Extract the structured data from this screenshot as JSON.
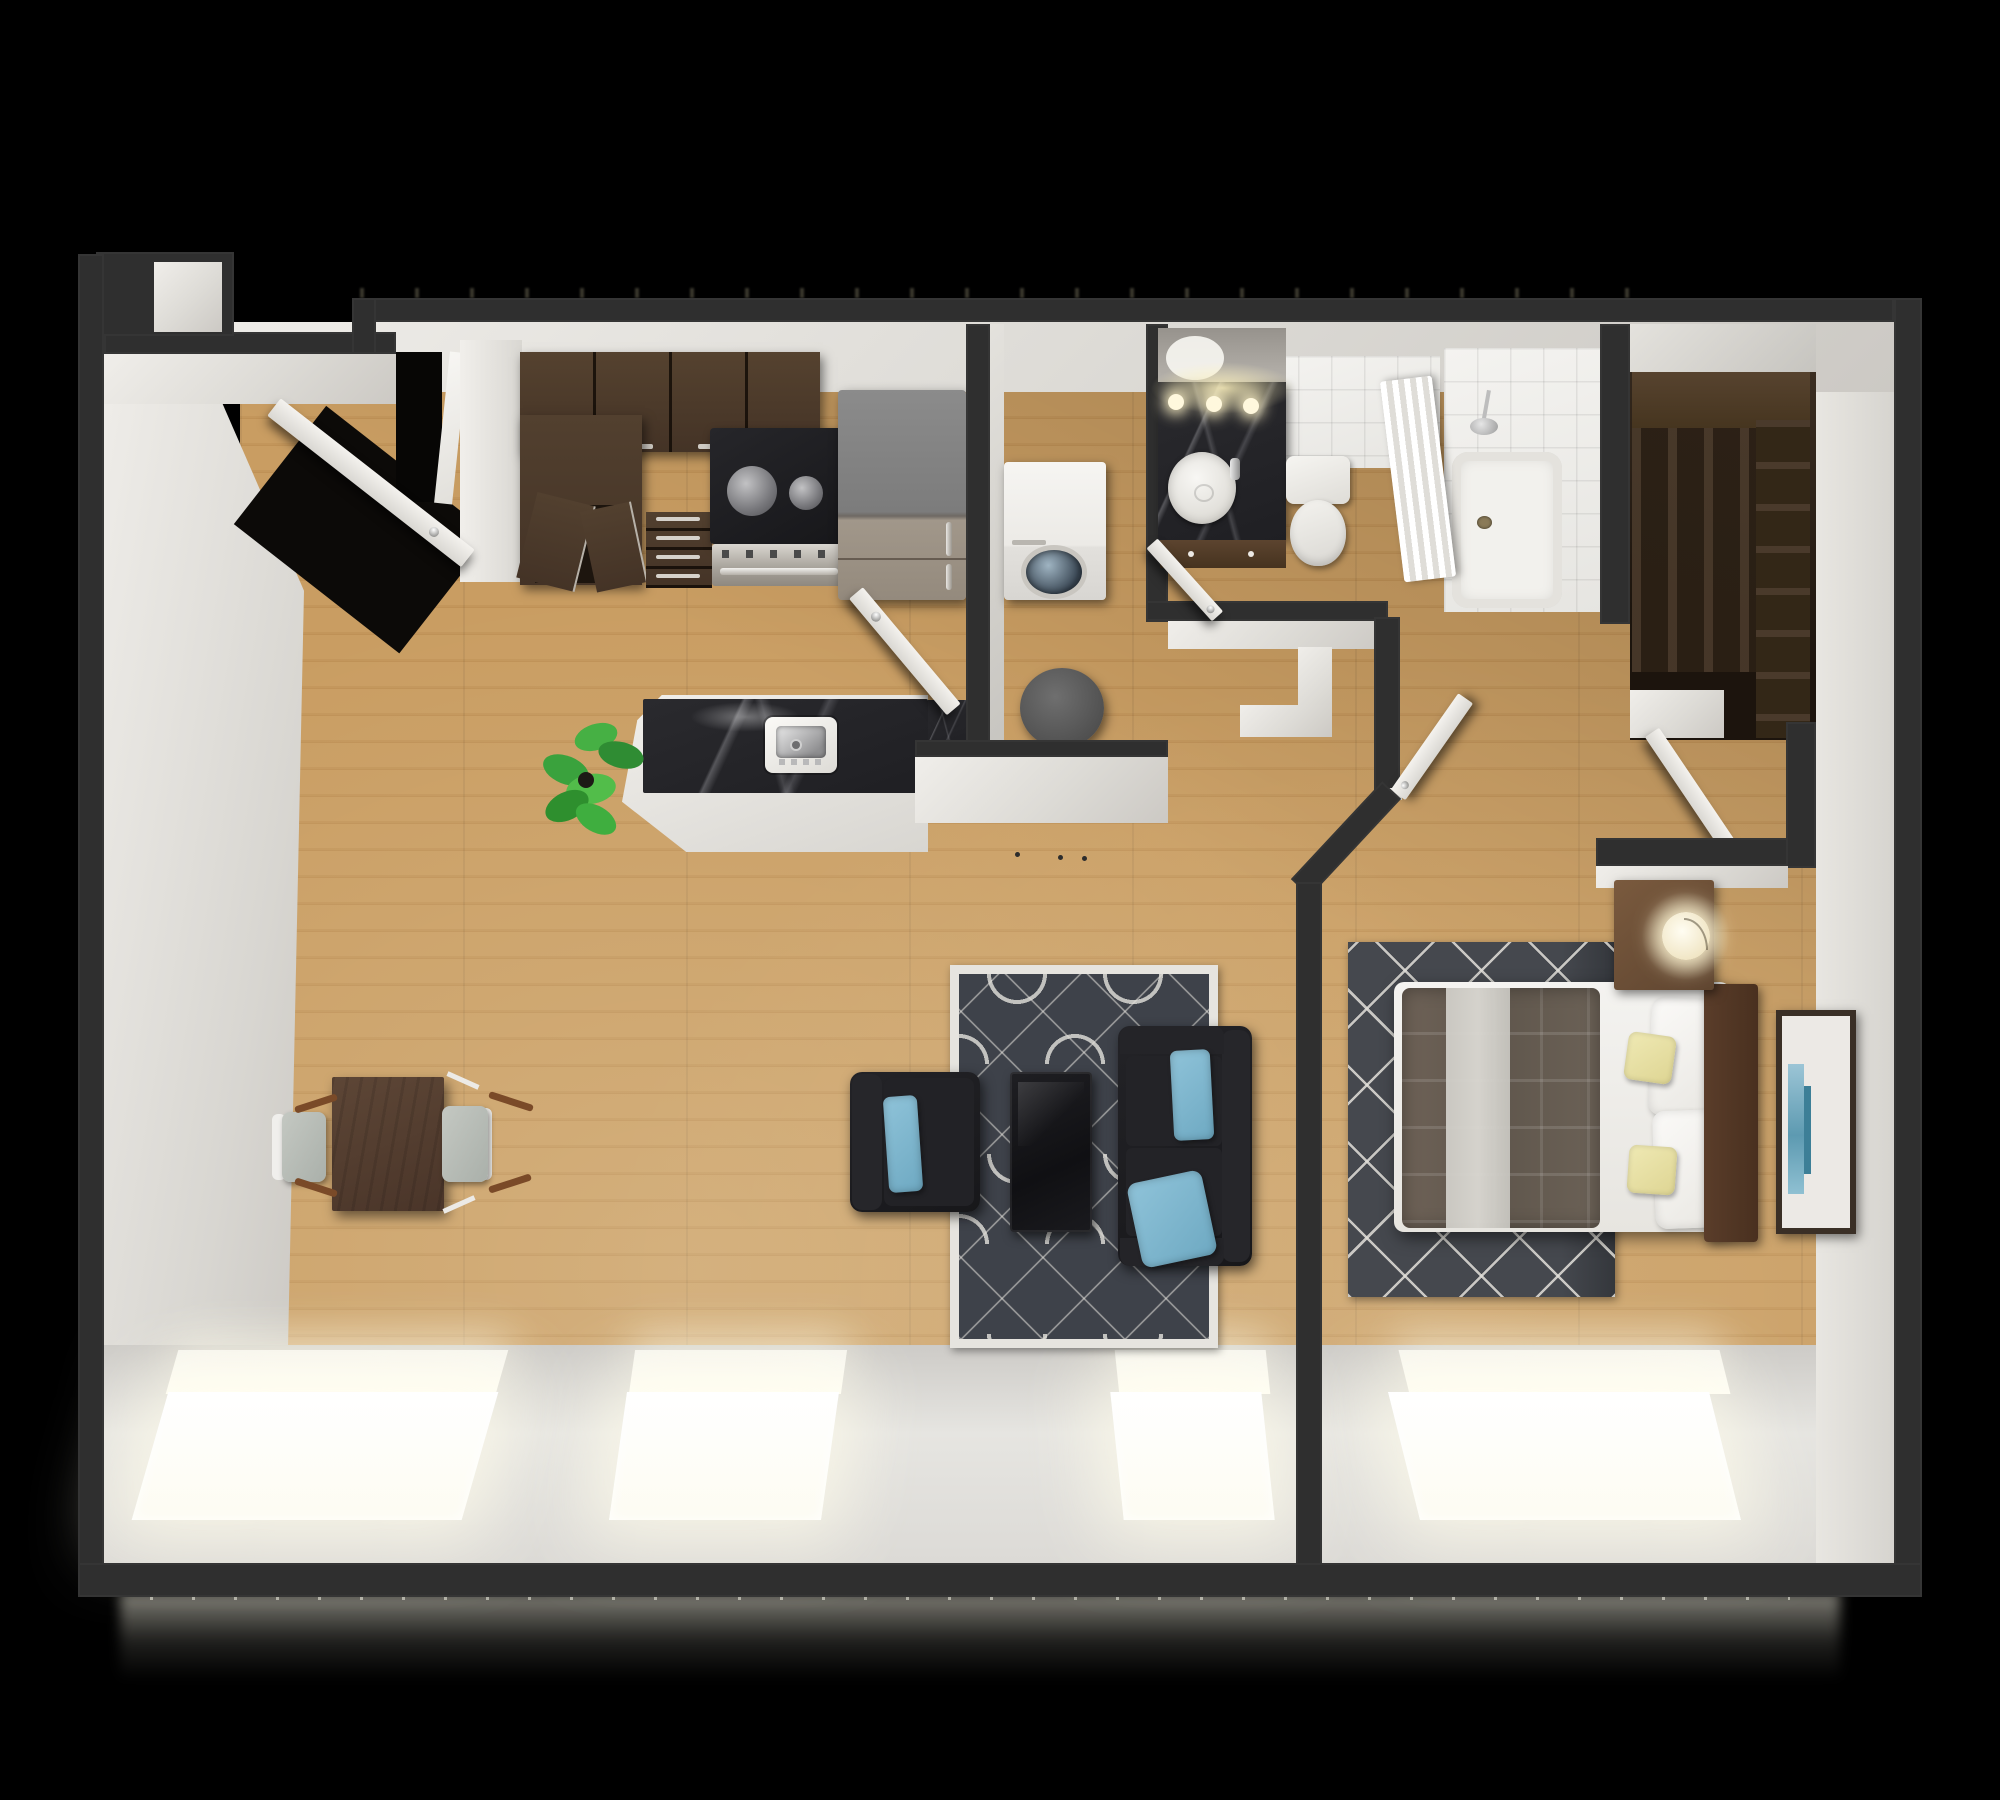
{
  "scene": {
    "kind": "3d-rendered-floor-plan",
    "view": "top-down dollhouse",
    "background": "#000000",
    "apartment_type": "one-bedroom apartment"
  },
  "palette": {
    "wall": "#2f2f2f",
    "wallLight": "#3f3f3f",
    "wallFace": "#e9e7e2",
    "wood": "#c59a5f",
    "marble": "#232327",
    "espresso": "#443326",
    "espressoTop": "#52402f",
    "espressoDeep": "#241a11",
    "fridgeGray": "#828282",
    "steel": "#b9b4ac",
    "furnitureWhite": "#f1f0ed",
    "accentBlue": "#7db6ce",
    "accentYellow": "#e9e2a5",
    "quilt": "#6b655a",
    "rugLiving": "#3e424a",
    "rugBedroom": "#45484e",
    "rugLine": "#e1dfd9",
    "headboard": "#4e3424",
    "nightstand": "#6f5138",
    "plantGreen": "#3fae3f",
    "windowGlow": "#fffce8"
  },
  "rooms": [
    {
      "name": "living-dining-room",
      "floor": "hardwood",
      "furniture": [
        "dining table",
        "2 dining chairs",
        "potted plant",
        "armchair with blue pillow",
        "loveseat sofa with 2 blue pillows",
        "dark coffee table",
        "patterned area rug"
      ]
    },
    {
      "name": "kitchen",
      "floor": "hardwood",
      "furniture": [
        "upper cabinets (4 doors)",
        "tall pantry cabinet with open doors",
        "drawer stack (4 drawers)",
        "range with 2 burners",
        "refrigerator",
        "island with black marble top and sink"
      ]
    },
    {
      "name": "laundry-nook",
      "floor": "hardwood",
      "furniture": [
        "front-load washer",
        "round gray side table"
      ]
    },
    {
      "name": "hallway",
      "floor": "hardwood",
      "furniture": []
    },
    {
      "name": "bathroom",
      "floor": "hardwood + white tile",
      "furniture": [
        "dark marble vanity with vessel sink",
        "mirror",
        "3-bulb vanity light",
        "toilet",
        "shower curtain",
        "bathtub with shower head"
      ]
    },
    {
      "name": "walk-in-closet",
      "floor": "hardwood",
      "furniture": [
        "dark espresso shelving unit"
      ]
    },
    {
      "name": "bedroom",
      "floor": "hardwood",
      "furniture": [
        "queen bed with gray quilt",
        "2 white pillows",
        "2 yellow accent pillows",
        "wood headboard",
        "nightstand with lit round lamp",
        "diamond-pattern rug",
        "framed blue artwork"
      ]
    }
  ],
  "doors": [
    {
      "name": "entry-door",
      "state": "open"
    },
    {
      "name": "laundry-door",
      "state": "open"
    },
    {
      "name": "bathroom-door",
      "state": "open"
    },
    {
      "name": "bedroom-door",
      "state": "open"
    },
    {
      "name": "closet-door",
      "state": "open"
    }
  ],
  "windows": {
    "count": 4,
    "location": "south wall",
    "state": "daylight glow"
  }
}
